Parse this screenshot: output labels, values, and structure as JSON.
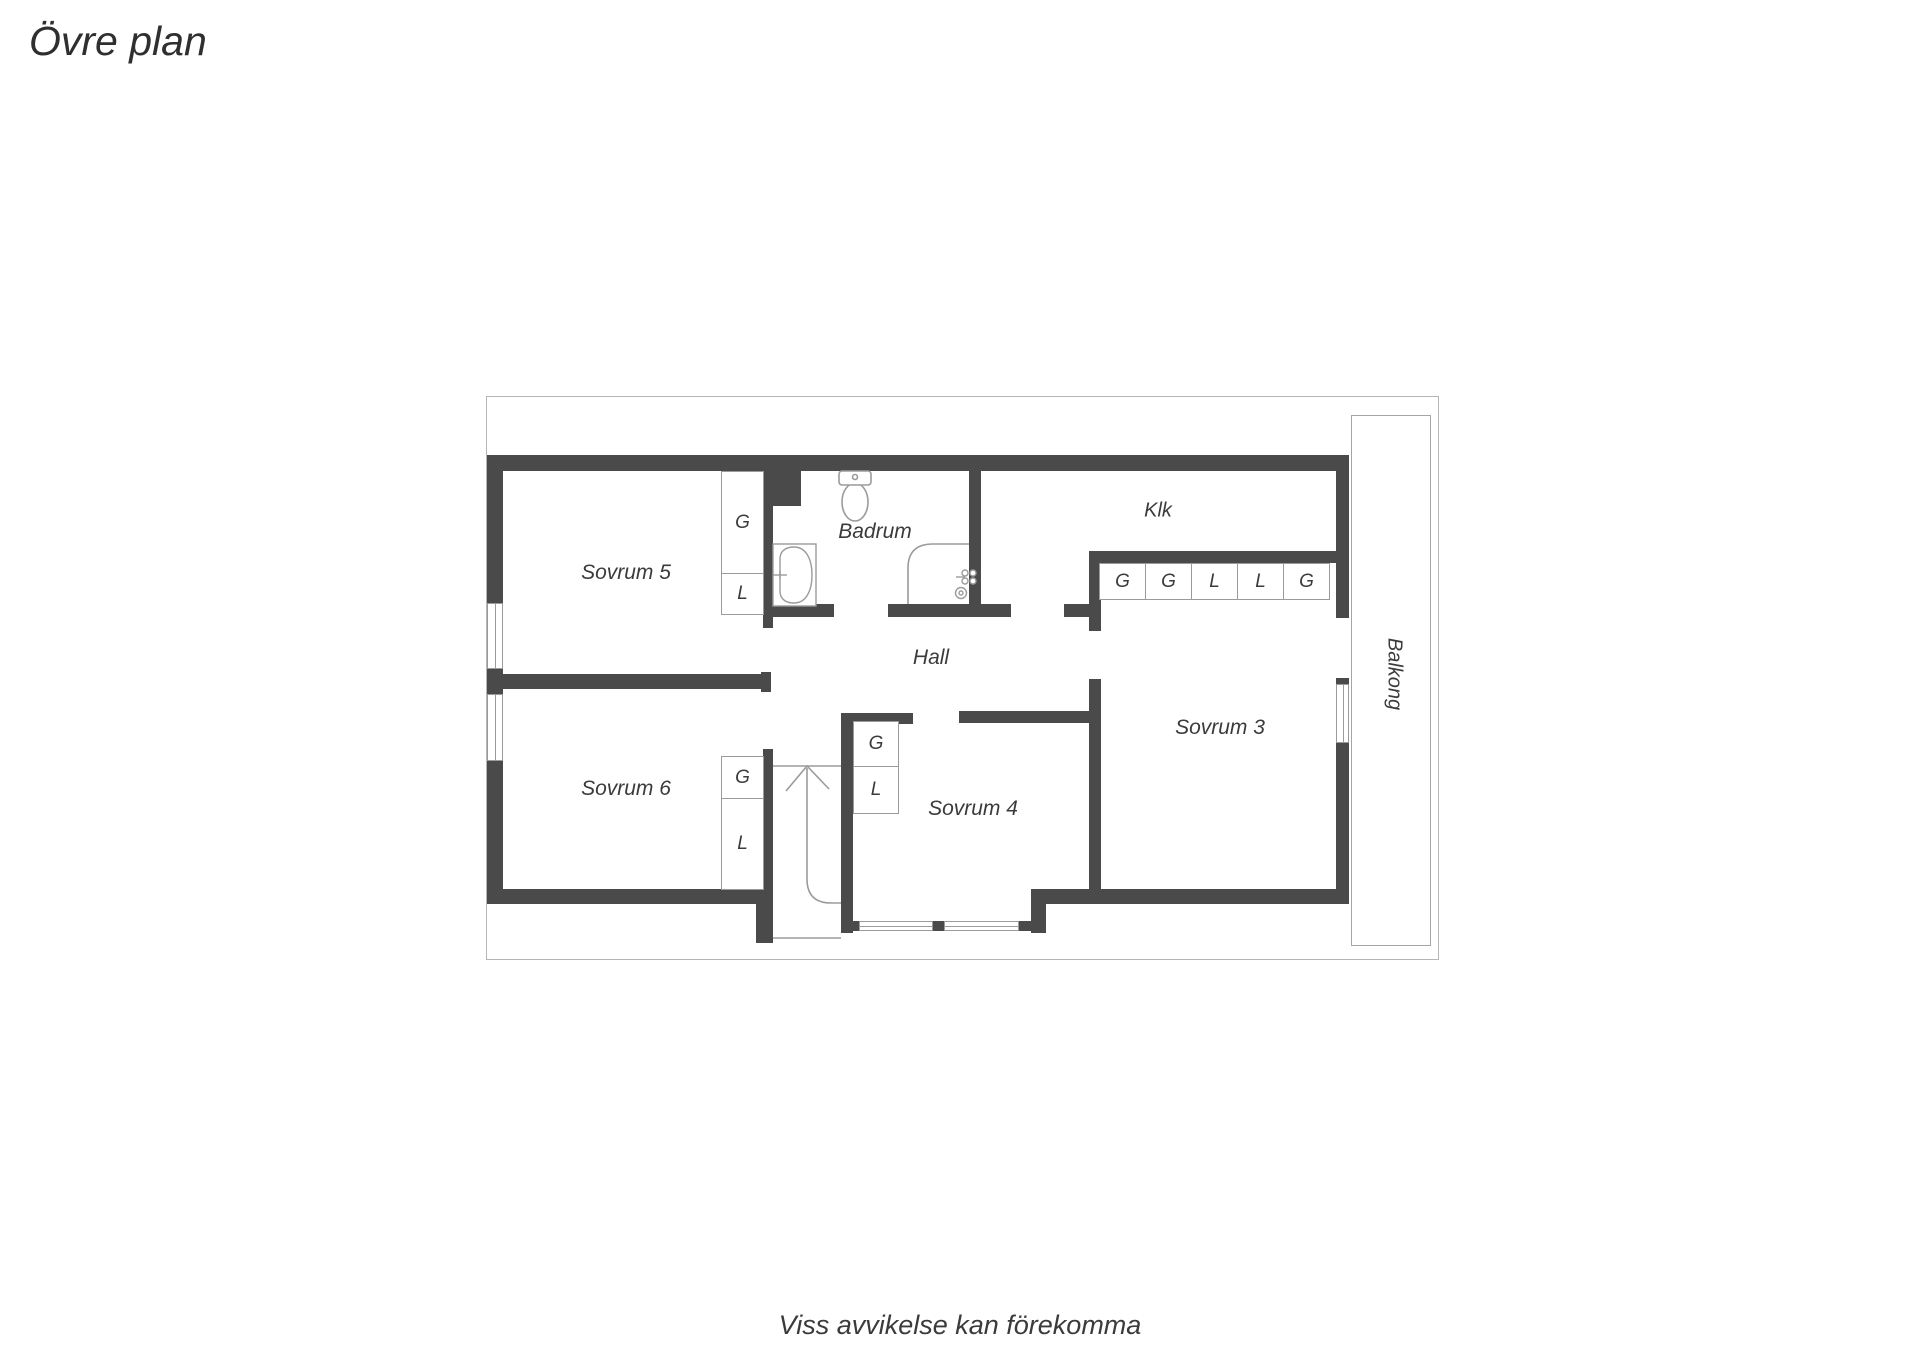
{
  "title": "Övre plan",
  "footer": "Viss avvikelse kan förekomma",
  "rooms": {
    "sovrum5": "Sovrum 5",
    "sovrum6": "Sovrum 6",
    "sovrum4": "Sovrum 4",
    "sovrum3": "Sovrum 3",
    "badrum": "Badrum",
    "hall": "Hall",
    "klk": "Klk",
    "balkong": "Balkong"
  },
  "wardrobes": {
    "sovrum5": [
      "G",
      "L"
    ],
    "sovrum6": [
      "G",
      "L"
    ],
    "sovrum4": [
      "G",
      "L"
    ],
    "klk": [
      "G",
      "G",
      "L",
      "L",
      "G"
    ]
  },
  "colors": {
    "wall": "#4a4a4a",
    "thin_line": "#9b9b9b",
    "frame": "#b5b5b5",
    "text": "#3b3b3b"
  }
}
